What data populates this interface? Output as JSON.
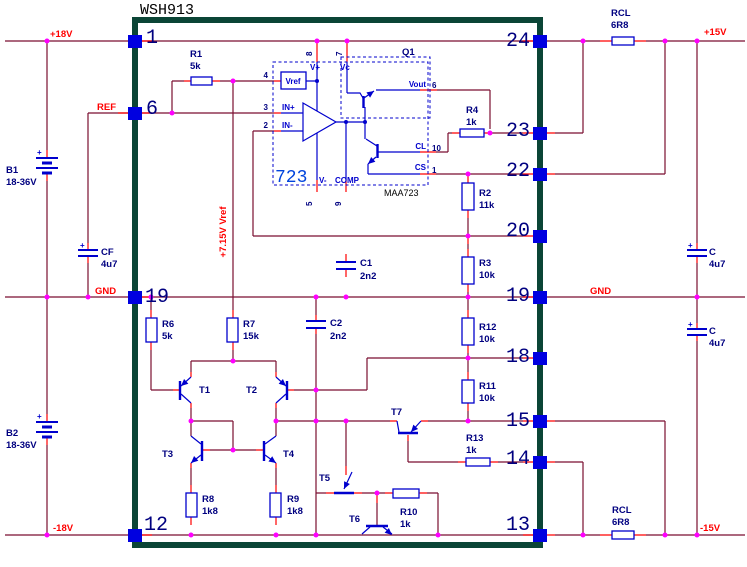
{
  "colors": {
    "wire": "#7a0f30",
    "red": "#ff0000",
    "blue": "#0000cd",
    "dot": "#ff00ff",
    "border": "#0b4536",
    "pin": "#0000e0",
    "navy": "#000080",
    "chip723": "#0044dd"
  },
  "title": "WSH913",
  "rails": {
    "p18": "+18V",
    "ref": "REF",
    "gnd_l": "GND",
    "m18": "-18V",
    "p15": "+15V",
    "gnd_r": "GND",
    "m15": "-15V",
    "vref": "+7.15V Vref"
  },
  "pins": {
    "left": [
      "1",
      "6",
      "19",
      "12"
    ],
    "right": [
      "24",
      "23",
      "22",
      "20",
      "19",
      "18",
      "15",
      "14",
      "13"
    ]
  },
  "chip": {
    "name": "723",
    "part": "MAA723",
    "q1": "Q1",
    "labels": {
      "vref": "Vref",
      "inp": "IN+",
      "inn": "IN-",
      "vp": "V+",
      "vc": "Vc",
      "vout": "Vout",
      "cl": "CL",
      "cs": "CS",
      "comp": "COMP",
      "vm": "V-"
    },
    "pins": {
      "p8": "8",
      "p7": "7",
      "p4": "4",
      "p3": "3",
      "p2": "2",
      "p5": "5",
      "p9": "9",
      "p6": "6",
      "p10": "10",
      "p1": "1"
    }
  },
  "components": {
    "plus": "+",
    "r1": {
      "ref": "R1",
      "val": "5k"
    },
    "r2": {
      "ref": "R2",
      "val": "11k"
    },
    "r3": {
      "ref": "R3",
      "val": "10k"
    },
    "r4": {
      "ref": "R4",
      "val": "1k"
    },
    "r6": {
      "ref": "R6",
      "val": "5k"
    },
    "r7": {
      "ref": "R7",
      "val": "15k"
    },
    "r8": {
      "ref": "R8",
      "val": "1k8"
    },
    "r9": {
      "ref": "R9",
      "val": "1k8"
    },
    "r10": {
      "ref": "R10",
      "val": "1k"
    },
    "r11": {
      "ref": "R11",
      "val": "10k"
    },
    "r12": {
      "ref": "R12",
      "val": "10k"
    },
    "r13": {
      "ref": "R13",
      "val": "1k"
    },
    "rcl_top": {
      "ref": "RCL",
      "val": "6R8"
    },
    "rcl_bot": {
      "ref": "RCL",
      "val": "6R8"
    },
    "b1": {
      "ref": "B1",
      "val": "18-36V"
    },
    "b2": {
      "ref": "B2",
      "val": "18-36V"
    },
    "cf": {
      "ref": "CF",
      "val": "4u7"
    },
    "c1": {
      "ref": "C1",
      "val": "2n2"
    },
    "c2": {
      "ref": "C2",
      "val": "2n2"
    },
    "c_top": {
      "ref": "C",
      "val": "4u7"
    },
    "c_bot": {
      "ref": "C",
      "val": "4u7"
    },
    "t1": "T1",
    "t2": "T2",
    "t3": "T3",
    "t4": "T4",
    "t5": "T5",
    "t6": "T6",
    "t7": "T7"
  }
}
